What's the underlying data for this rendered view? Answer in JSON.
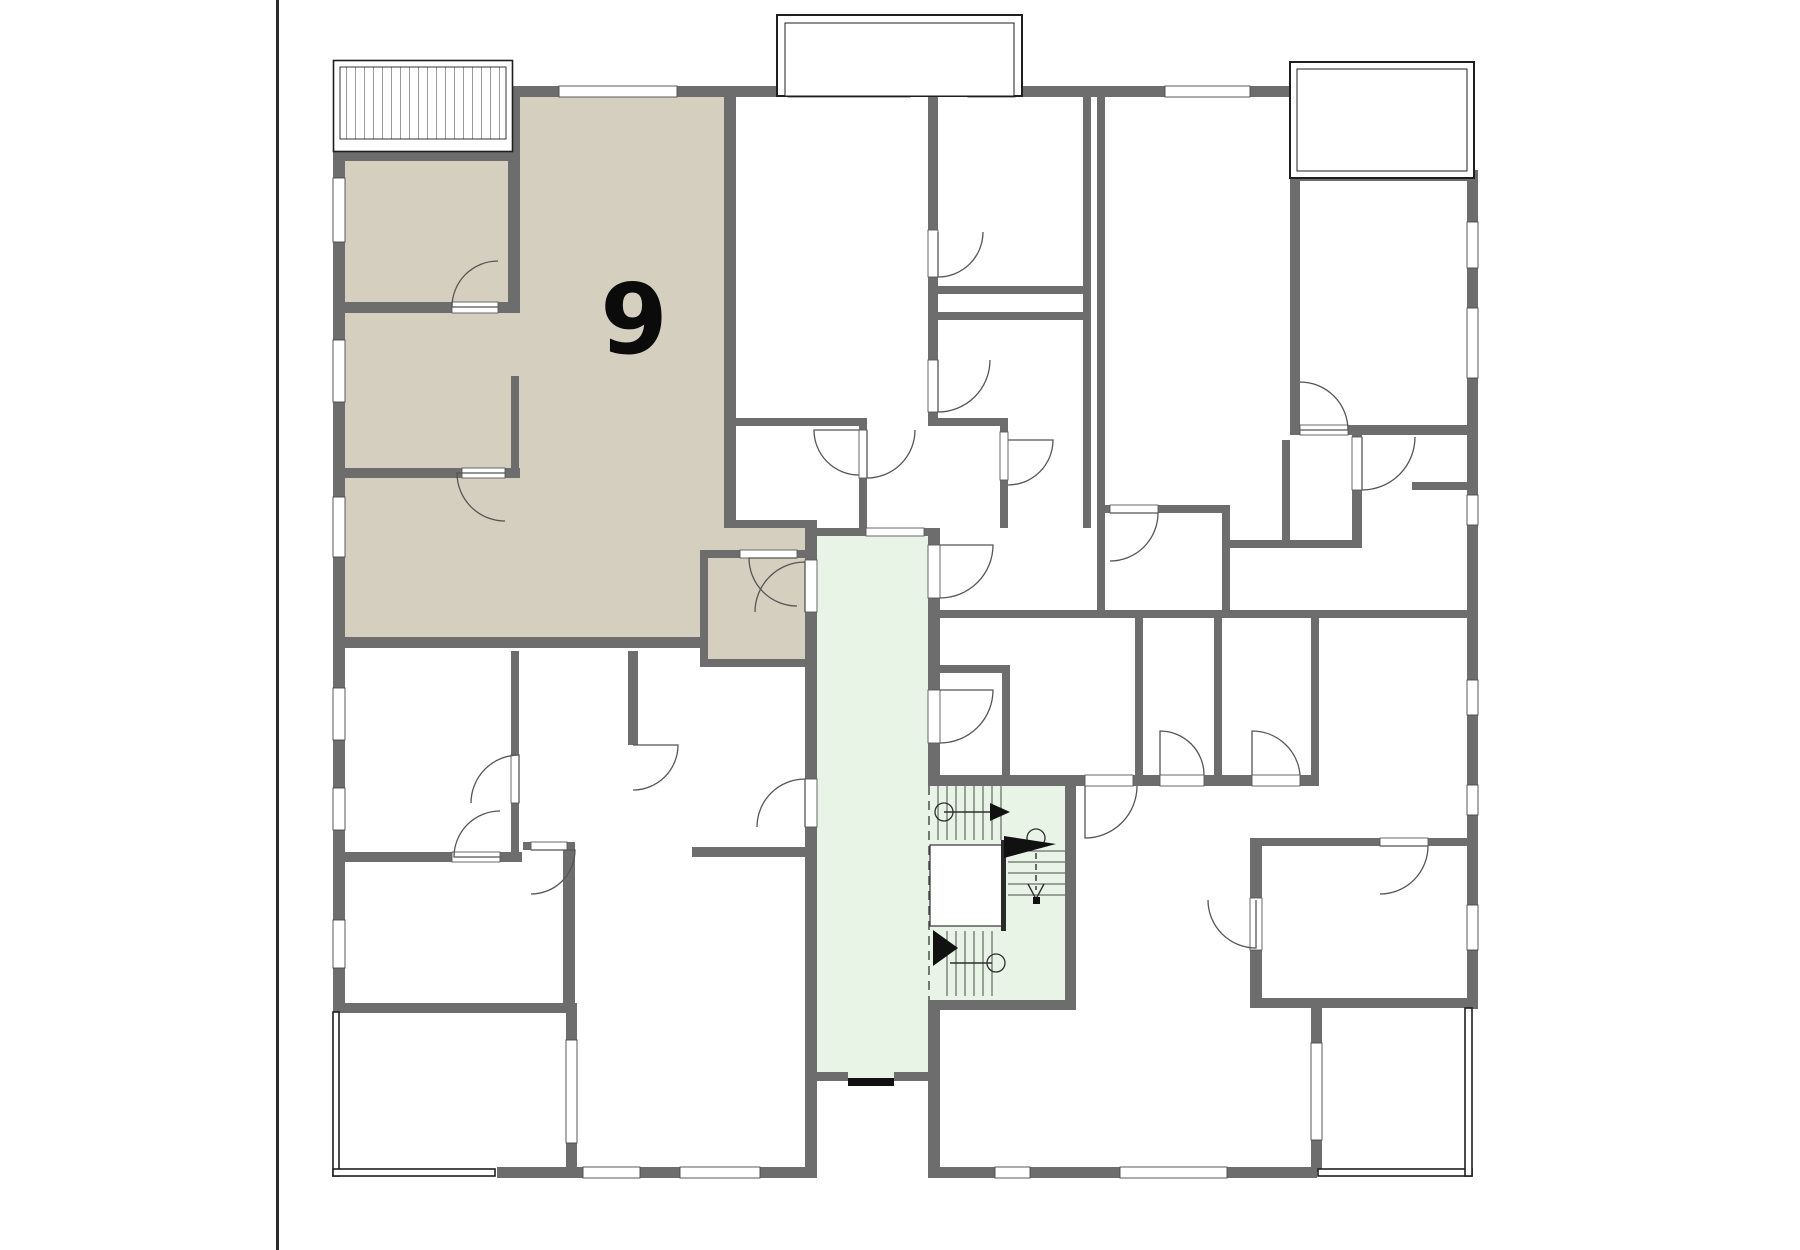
{
  "floorplan": {
    "unit_label": "9",
    "colors": {
      "wall": "#6d6d6d",
      "unit_highlight": "#d5cfc0",
      "stairwell": "#e8f5e6",
      "door_arc": "#555555",
      "entrance_door": "#111111",
      "outline": "#1f1f1f",
      "hatch": "#9a9a9a",
      "background": "#ffffff"
    },
    "regions": [
      {
        "name": "apartment-unit-9",
        "kind": "highlighted-unit",
        "label": "9"
      },
      {
        "name": "central-corridor",
        "kind": "circulation"
      },
      {
        "name": "stairwell",
        "kind": "circulation"
      },
      {
        "name": "top-center-apartment",
        "kind": "unit"
      },
      {
        "name": "top-right-apartment",
        "kind": "unit"
      },
      {
        "name": "bottom-left-apartment",
        "kind": "unit"
      },
      {
        "name": "bottom-right-apartment",
        "kind": "unit"
      },
      {
        "name": "balcony-top-left-hatched",
        "kind": "balcony"
      },
      {
        "name": "balcony-top-center",
        "kind": "balcony"
      },
      {
        "name": "balcony-top-right",
        "kind": "balcony"
      },
      {
        "name": "terrace-bottom-left",
        "kind": "terrace"
      },
      {
        "name": "terrace-bottom-right",
        "kind": "terrace"
      },
      {
        "name": "main-entrance-door",
        "kind": "entrance"
      }
    ]
  }
}
